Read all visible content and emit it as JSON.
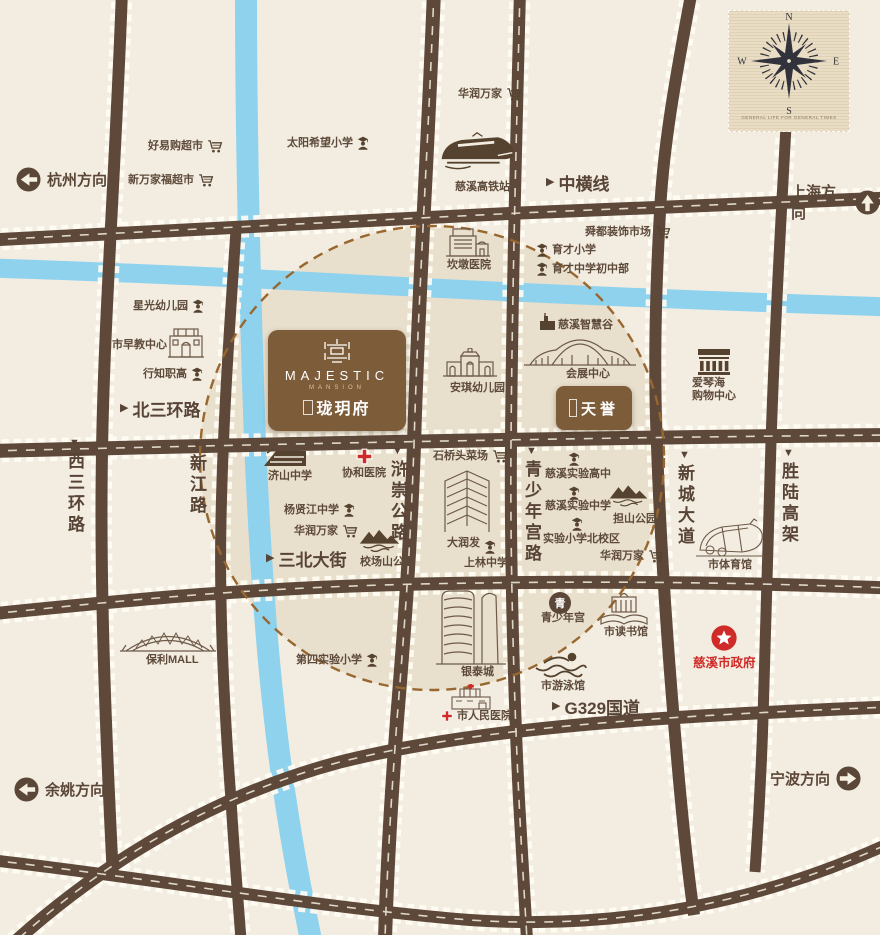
{
  "colors": {
    "background": "#f3ede1",
    "road": "#5d4839",
    "river": "#8ed2ee",
    "brand_brown": "#7d5c3a",
    "accent_red": "#cf2b28",
    "label_brown": "#5e4a3a"
  },
  "compass": {
    "n": "N",
    "e": "E",
    "s": "S",
    "w": "W",
    "caption": "GENERAL LIFE FOR GENERAL TIMES"
  },
  "project": {
    "name_en": "MAJESTIC",
    "type_en": "MANSION",
    "name_cn": "珑玥府",
    "icon": "brand-emblem"
  },
  "competitor": {
    "name": "天誉"
  },
  "directions": {
    "hangzhou": {
      "label": "杭州方向",
      "icon": "arrow-left-circle"
    },
    "shanghai": {
      "label": "上海方向",
      "icon": "arrow-up-circle"
    },
    "yuyao": {
      "label": "余姚方向",
      "icon": "arrow-left-circle"
    },
    "ningbo": {
      "label": "宁波方向",
      "icon": "arrow-right-circle"
    }
  },
  "roads": {
    "zhonghengxian": {
      "marker": "▶",
      "label": "中横线"
    },
    "beisanhuanlu": {
      "marker": "▶",
      "label": "北三环路"
    },
    "sanbeidajie": {
      "marker": "▶",
      "label": "三北大街"
    },
    "g329": {
      "marker": "▶",
      "label": "G329国道"
    },
    "xisanhuanlu": {
      "marker": "▼",
      "label": "西三环路"
    },
    "xinjianglu": {
      "marker": "▼",
      "label": "新江路"
    },
    "huchonggonglu": {
      "marker": "▼",
      "label": "浒崇公路"
    },
    "qingshaoniangonglu": {
      "marker": "▼",
      "label": "青少年宫路"
    },
    "xinchengdadao": {
      "marker": "▼",
      "label": "新城大道"
    },
    "shengluhaojia": {
      "marker": "▼",
      "label": "胜陆高架"
    }
  },
  "pois": {
    "haoyigou": {
      "label": "好易购超市",
      "icon": "cart-icon"
    },
    "xinwanjiafu": {
      "label": "新万家福超市",
      "icon": "cart-icon"
    },
    "taiyang": {
      "label": "太阳希望小学",
      "icon": "student-icon"
    },
    "huarun_top": {
      "label": "华润万家",
      "icon": "cart-icon"
    },
    "gaotie": {
      "label": "慈溪高铁站",
      "icon": "train-icon"
    },
    "shundu": {
      "label": "舜都装饰市场",
      "icon": "cart-icon"
    },
    "yucai_xiaoxue": {
      "label": "育才小学",
      "icon": "student-icon"
    },
    "yucai_chuzhong": {
      "label": "育才中学初中部",
      "icon": "student-icon"
    },
    "xingguang": {
      "label": "星光幼儿园",
      "icon": "student-icon"
    },
    "zaojiao": {
      "label": "市早教中心",
      "icon": "building-icon"
    },
    "xingzhi": {
      "label": "行知职高",
      "icon": "student-icon"
    },
    "kandun": {
      "label": "坎墩医院",
      "icon": "hospital-building-icon"
    },
    "zhihuigu": {
      "label": "慈溪智慧谷",
      "icon": "building-icon"
    },
    "huizhan": {
      "label": "会展中心",
      "icon": "exhibition-hall-icon"
    },
    "aiqinhai": {
      "label": "爱琴海",
      "label2": "购物中心",
      "icon": "mall-building-icon"
    },
    "anqi": {
      "label": "安琪幼儿园",
      "icon": "kindergarten-building-icon"
    },
    "jishan": {
      "label": "济山中学",
      "icon": "school-building-icon"
    },
    "xiehe": {
      "label": "协和医院",
      "icon": "red-cross-icon"
    },
    "yangxianjiang": {
      "label": "杨贤江中学",
      "icon": "student-icon"
    },
    "huarun_mid": {
      "label": "华润万家",
      "icon": "cart-icon"
    },
    "xiaochangshan": {
      "label": "校场山公园",
      "icon": "mountain-park-icon"
    },
    "shiqiaotou": {
      "label": "石桥头菜场",
      "icon": "cart-icon"
    },
    "darunfa": {
      "label": "大润发",
      "icon": "tower-building-icon"
    },
    "shanglin": {
      "label": "上林中学",
      "icon": "student-icon"
    },
    "shiyan_gaozhong": {
      "label": "慈溪实验高中",
      "icon": "student-icon"
    },
    "shiyan_zhongxue": {
      "label": "慈溪实验中学",
      "icon": "student-icon"
    },
    "danshan": {
      "label": "担山公园",
      "icon": "mountain-park-icon"
    },
    "shiyan_beixiaoqu": {
      "label": "实验小学北校区",
      "icon": "student-icon"
    },
    "huarun_right": {
      "label": "华润万家",
      "icon": "cart-icon"
    },
    "tiyuguan": {
      "label": "市体育馆",
      "icon": "stadium-icon"
    },
    "baoli": {
      "label": "保利MALL",
      "icon": "arch-mall-icon"
    },
    "disi": {
      "label": "第四实验小学",
      "icon": "student-icon"
    },
    "yintai": {
      "label": "银泰城",
      "icon": "twin-tower-icon"
    },
    "qsn_gong": {
      "label": "青少年宫",
      "badge": "青",
      "icon": "circle-badge-icon"
    },
    "dushuguan": {
      "label": "市读书馆",
      "icon": "library-icon"
    },
    "youyongguan": {
      "label": "市游泳馆",
      "icon": "swimmer-icon"
    },
    "renmin": {
      "label": "市人民医院",
      "icon": "hospital-cross-icon"
    },
    "zhengfu": {
      "label": "慈溪市政府",
      "icon": "gov-star-icon"
    }
  }
}
